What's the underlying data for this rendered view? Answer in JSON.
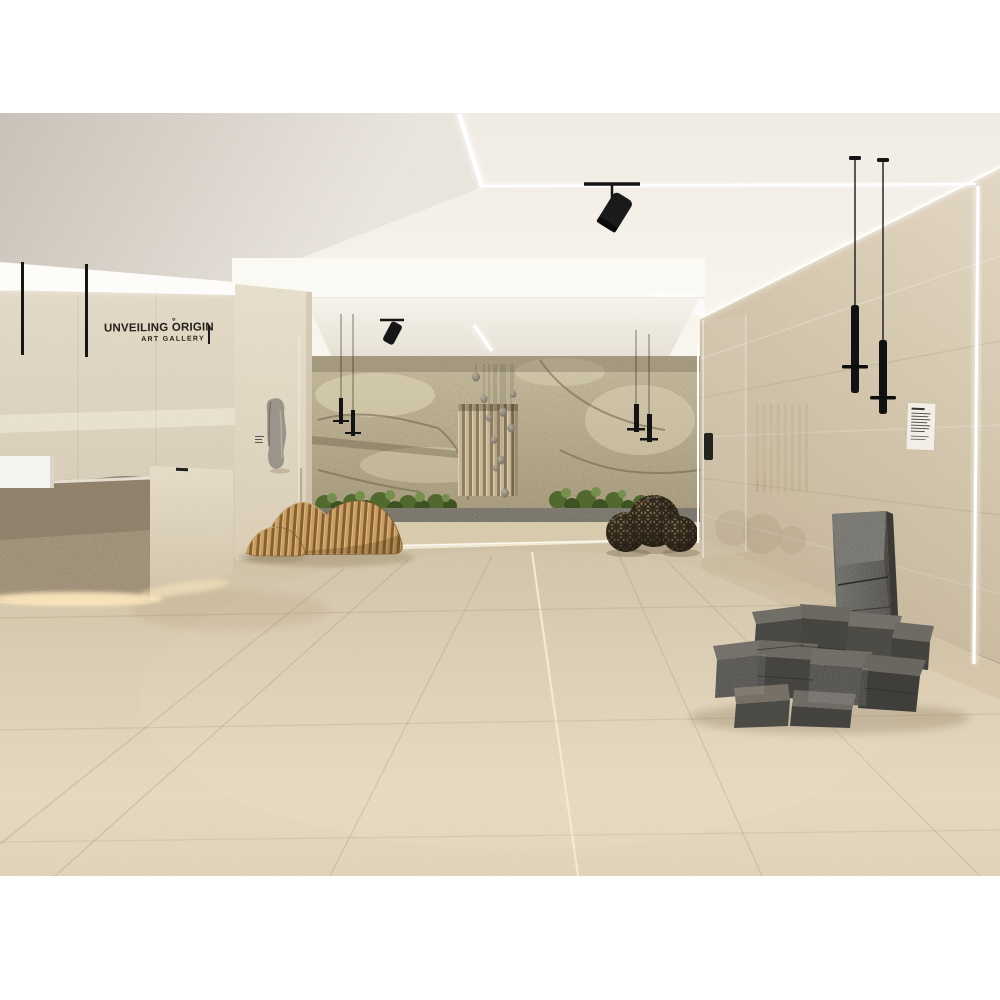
{
  "scene": {
    "type": "architectural-interior-render",
    "subject": "minimalist travertine art gallery hall"
  },
  "signage": {
    "title": "UNVEILING ORIGIN",
    "subtitle": "ART GALLERY",
    "accent_mark": "°"
  },
  "palette": {
    "background": "#ffffff",
    "ceiling": "#f3efe8",
    "ceiling_shadow": "#cbc4ba",
    "left_wall": "#ddd0b9",
    "right_wall": "#d5c6ab",
    "rock_wall": "#c3b695",
    "floor_back": "#cfc1a4",
    "floor_front": "#e8dabf",
    "wood": "#c89e63",
    "fixture_black": "#161616",
    "stone_gray": "#4b4945",
    "plant_green": "#51682f",
    "warm_glow": "#ffe9bf",
    "led_white": "#ffffff"
  },
  "objects": [
    "recessed ceiling LED light lines",
    "black track spotlight on ceiling",
    "stone reception desk with illuminated base",
    "gallery name lettering on wall",
    "black pendant rod lights",
    "rock feature wall alcove",
    "slatted timber panel with suspended stones",
    "planting bed with gravel strip",
    "parametric ribbed wood bench sculptures",
    "three woven sphere sculptures",
    "glass partition panels",
    "wall-mounted stone artwork with small label",
    "small white wall plaque",
    "two black cylinder pendant lights",
    "vertical LED cove light strips",
    "split-face basalt block installation",
    "large-format travertine floor tiles"
  ]
}
